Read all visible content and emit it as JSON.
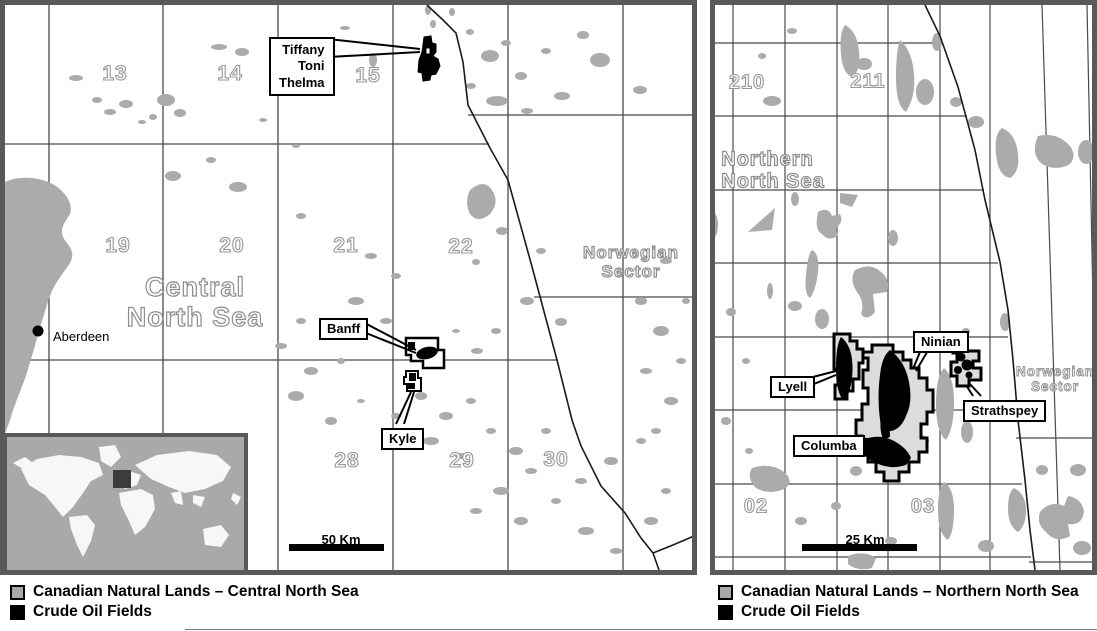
{
  "colors": {
    "panel_border": "#58595b",
    "grid_line": "#4a4a4a",
    "land_gray": "#ababab",
    "block_fill": "#dcdcdc",
    "field_black": "#000000"
  },
  "left_panel": {
    "quadrants": [
      "13",
      "14",
      "15",
      "19",
      "20",
      "21",
      "22",
      "28",
      "29",
      "30"
    ],
    "sea_label": [
      "Central",
      "North Sea"
    ],
    "sector_label": [
      "Norwegian",
      "Sector"
    ],
    "city": "Aberdeen",
    "fields": {
      "tiffany_group": [
        "Tiffany",
        "Toni",
        "Thelma"
      ],
      "banff": "Banff",
      "kyle": "Kyle"
    },
    "scale": "50 Km",
    "legend": [
      {
        "swatch": "gray",
        "label": "Canadian Natural Lands – Central North Sea"
      },
      {
        "swatch": "black",
        "label": "Crude Oil Fields"
      }
    ]
  },
  "right_panel": {
    "quadrants": [
      "210",
      "211",
      "02",
      "03"
    ],
    "sea_label": [
      "Northern",
      "North Sea"
    ],
    "sector_label": [
      "Norwegian",
      "Sector"
    ],
    "fields": {
      "lyell": "Lyell",
      "ninian": "Ninian",
      "columba": "Columba",
      "strathspey": "Strathspey"
    },
    "scale": "25 Km",
    "legend": [
      {
        "swatch": "gray",
        "label": "Canadian Natural Lands – Northern North Sea"
      },
      {
        "swatch": "black",
        "label": "Crude Oil Fields"
      }
    ]
  }
}
